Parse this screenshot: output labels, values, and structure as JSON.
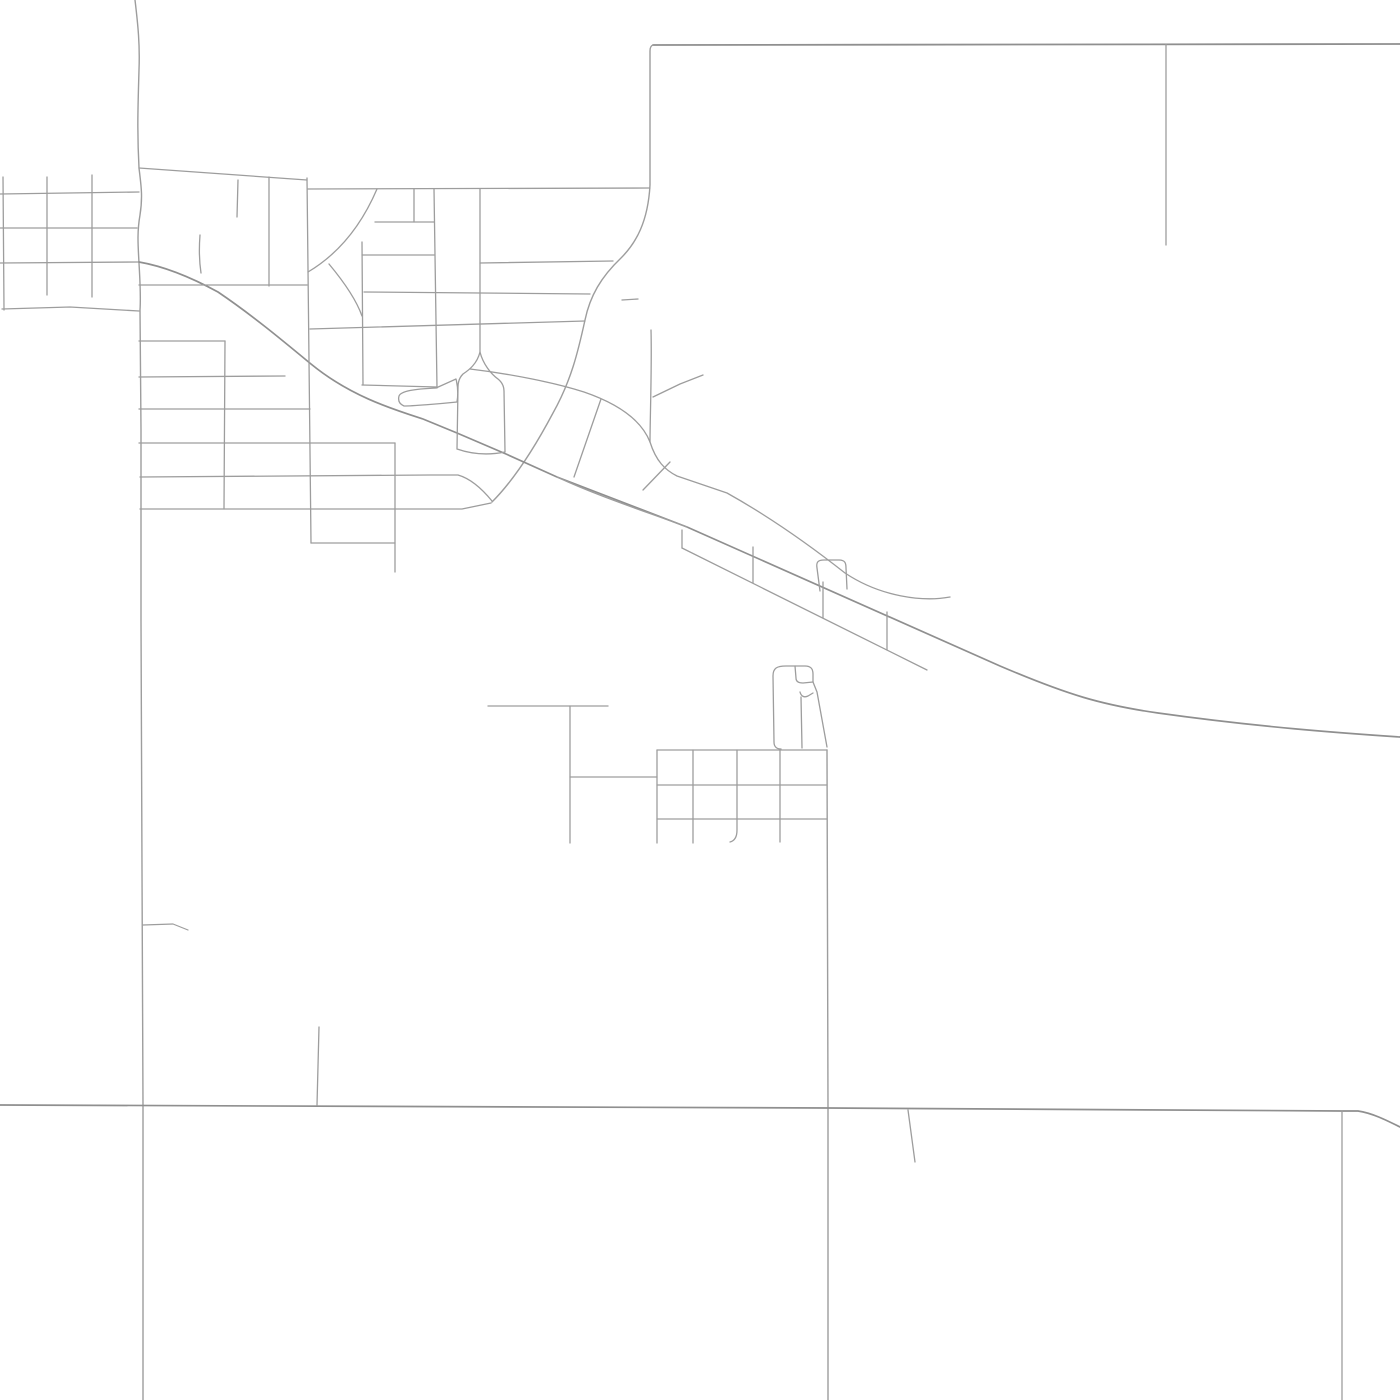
{
  "canvas": {
    "width": 1400,
    "height": 1400,
    "background_color": "#ffffff"
  },
  "map": {
    "kind": "minimal-street-map",
    "road_color_default": "#9d9d9d",
    "road_color_major": "#8f8f8f",
    "road_width_default": 1.3,
    "road_width_major": 1.7,
    "roads": [
      {
        "name": "boundary-top-road",
        "d": "M653,45 L1400,44",
        "width": 1.8,
        "color": "#8f8f8f"
      },
      {
        "name": "boundary-west-scurve-road",
        "d": "M653,45 Q650,46 650,51 L650,185 C648,222 636,243 621,258 C601,277 590,296 585,320 C578,352 571,381 553,413 C536,445 516,478 492,502",
        "width": 1.4
      },
      {
        "name": "north-vertical-road",
        "d": "M1166,44 L1166,245"
      },
      {
        "name": "west-boundary-wavy-road",
        "d": "M135,0 C138,25 140,45 139,70 C138,105 137,130 139,168 C141,185 143,196 140,215 C137,232 138,245 139,263 C140,282 141,295 140,310 L141,430 L141,620 L142,870 L143,1106 L143,1400",
        "width": 1.4
      },
      {
        "name": "west-branch-road",
        "d": "M143,925 L173,924 L188,930",
        "width": 1.2
      },
      {
        "name": "nw-grid-h1",
        "d": "M0,194 L139,192"
      },
      {
        "name": "nw-grid-h2",
        "d": "M0,228 L137,228"
      },
      {
        "name": "nw-grid-h3",
        "d": "M0,263 L139,262"
      },
      {
        "name": "nw-grid-h4",
        "d": "M2,309 L70,307 L139,311"
      },
      {
        "name": "nw-grid-v1",
        "d": "M3,177 L4,310"
      },
      {
        "name": "nw-grid-v2",
        "d": "M47,177 L47,295"
      },
      {
        "name": "nw-grid-v3",
        "d": "M92,175 L92,297"
      },
      {
        "name": "main-highway",
        "d": "M139,262 C168,267 196,280 218,292 C252,315 282,340 311,364 C350,396 392,409 423,419 L457,433 L506,454 L557,477 L687,527 L1000,666 C1068,695 1102,705 1158,713 C1258,727 1340,733 1400,737",
        "width": 1.7,
        "color": "#8f8f8f"
      },
      {
        "name": "highway-south-carriageway",
        "d": "M557,477 C600,497 650,513 687,527"
      },
      {
        "name": "north-box-top-road",
        "d": "M139,168 L307,180"
      },
      {
        "name": "north-box-east-road",
        "d": "M307,178 L311,543"
      },
      {
        "name": "north-box-inner-v1",
        "d": "M238,180 L237,217"
      },
      {
        "name": "north-box-inner-v2",
        "d": "M269,177 L269,286"
      },
      {
        "name": "north-box-bottom-road",
        "d": "M139,285 L307,285"
      },
      {
        "name": "small-squiggle-road",
        "d": "M200,235 C199,248 199,260 201,273"
      },
      {
        "name": "mid-north-horizontal-road",
        "d": "M308,189 L650,188"
      },
      {
        "name": "quarter-arc-road",
        "d": "M377,189 C362,224 340,253 308,272"
      },
      {
        "name": "small-arc-road",
        "d": "M329,264 C344,282 356,299 362,316"
      },
      {
        "name": "mid-vertical-362",
        "d": "M362,242 L363,385"
      },
      {
        "name": "mid-horizontal-385",
        "d": "M362,385 L437,387"
      },
      {
        "name": "mid-vertical-414",
        "d": "M414,189 L414,222"
      },
      {
        "name": "mid-horizontal-222",
        "d": "M375,222 L434,222"
      },
      {
        "name": "mid-horizontal-255",
        "d": "M362,255 L434,255"
      },
      {
        "name": "mid-vertical-434",
        "d": "M434,189 L437,388"
      },
      {
        "name": "pond-outline",
        "d": "M399,396 C401,391 414,389 436,388 L456,379 C458,387 458,396 457,402 C438,404 412,406 404,406 C399,404 398,400 399,396 Z"
      },
      {
        "name": "mid-vertical-480",
        "d": "M480,189 L480,352"
      },
      {
        "name": "mid-horizontal-263",
        "d": "M480,263 L613,261"
      },
      {
        "name": "mid-horizontal-291",
        "d": "M364,292 L590,294"
      },
      {
        "name": "mid-horizontal-329",
        "d": "M310,329 L585,321"
      },
      {
        "name": "small-dash-road",
        "d": "M622,300 L638,299"
      },
      {
        "name": "balloon-loop-road",
        "d": "M480,352 C477,364 469,370 463,374 C459,378 458,382 458,387 L457,449 M480,352 C483,364 491,374 498,379 C503,383 504,387 504,391 L505,452 M457,449 Q480,457 505,452"
      },
      {
        "name": "bulb-upper-arc-road",
        "d": "M470,369 C512,374 556,383 584,392 C616,403 641,419 650,442"
      },
      {
        "name": "bulb-hatch-1",
        "d": "M601,399 L574,477"
      },
      {
        "name": "bulb-hatch-2",
        "d": "M643,490 L670,462"
      },
      {
        "name": "stub-road-651",
        "d": "M651,330 C652,365 650,420 650,442"
      },
      {
        "name": "frontage-road",
        "d": "M650,442 C656,461 665,470 677,476 L727,493 C770,517 812,547 845,573 C881,597 923,602 950,597"
      },
      {
        "name": "d-loop-road",
        "d": "M820,591 L817,568 C816,562 818,560 824,560 L839,560 C845,560 846,563 846,568 L847,589"
      },
      {
        "name": "ladder-lower-road",
        "d": "M682,548 L927,670"
      },
      {
        "name": "ladder-tie-1",
        "d": "M682,530 L682,548"
      },
      {
        "name": "ladder-tie-2",
        "d": "M753,547 L753,583"
      },
      {
        "name": "ladder-tie-3",
        "d": "M823,582 L823,618"
      },
      {
        "name": "ladder-tie-4",
        "d": "M887,612 L887,650"
      },
      {
        "name": "ne-branch-road",
        "d": "M653,397 L680,384 L703,375"
      },
      {
        "name": "hook-upper-road",
        "d": "M140,477 L430,475 L458,475 C472,479 483,490 492,501"
      },
      {
        "name": "hook-lower-road",
        "d": "M140,509 L462,509 L491,503"
      },
      {
        "name": "sw-grid-h-341",
        "d": "M139,341 L225,341"
      },
      {
        "name": "sw-grid-h-377",
        "d": "M139,377 L285,376"
      },
      {
        "name": "sw-grid-h-409",
        "d": "M139,409 L310,409"
      },
      {
        "name": "sw-grid-h-443",
        "d": "M139,443 L395,443"
      },
      {
        "name": "sw-grid-v-225",
        "d": "M225,341 L224,509"
      },
      {
        "name": "sw-grid-v-395",
        "d": "M395,443 L395,572"
      },
      {
        "name": "sw-grid-h-543",
        "d": "M311,543 L395,543"
      },
      {
        "name": "t-road-horizontal",
        "d": "M488,706 L608,706"
      },
      {
        "name": "t-road-vertical",
        "d": "M570,706 L570,843"
      },
      {
        "name": "t-road-connector",
        "d": "M570,777 L657,777"
      },
      {
        "name": "south-grid-h1",
        "d": "M657,750 L827,750"
      },
      {
        "name": "south-grid-h2",
        "d": "M657,785 L827,785"
      },
      {
        "name": "south-grid-h3",
        "d": "M657,819 L827,819"
      },
      {
        "name": "south-grid-v1",
        "d": "M657,750 L657,843"
      },
      {
        "name": "south-grid-v2",
        "d": "M693,750 L693,843"
      },
      {
        "name": "south-grid-v3",
        "d": "M737,750 L737,830 C737,838 734,841 730,842"
      },
      {
        "name": "south-grid-v4",
        "d": "M780,750 L780,842"
      },
      {
        "name": "long-south-vertical-road",
        "d": "M827,750 L828,1108 L828,1400",
        "width": 1.4
      },
      {
        "name": "building-shape-outline",
        "d": "M774,742 C774,747 777,749 781,749 M774,742 L773,676 C773,668 777,666 786,666 L805,666 C811,666 813,669 813,674 L813,682"
      },
      {
        "name": "building-shape-notch",
        "d": "M795,666 L796,678 C796,682 799,683 803,683 L813,682"
      },
      {
        "name": "building-shape-hook",
        "d": "M800,692 C801,696 804,698 808,696 L813,693"
      },
      {
        "name": "building-shape-right-edge",
        "d": "M813,682 L817,692 L827,747"
      },
      {
        "name": "building-shape-inner-v",
        "d": "M801,697 L802,748"
      },
      {
        "name": "bottom-section-road",
        "d": "M0,1105 L828,1108 L1342,1111 L1358,1111 C1372,1113 1386,1120 1400,1127",
        "width": 1.7,
        "color": "#8f8f8f"
      },
      {
        "name": "bottom-stub-317",
        "d": "M319,1027 L317,1105"
      },
      {
        "name": "bottom-vertical-1342",
        "d": "M1342,1111 L1342,1400"
      },
      {
        "name": "bottom-stub-908",
        "d": "M908,1110 L915,1162"
      }
    ]
  }
}
